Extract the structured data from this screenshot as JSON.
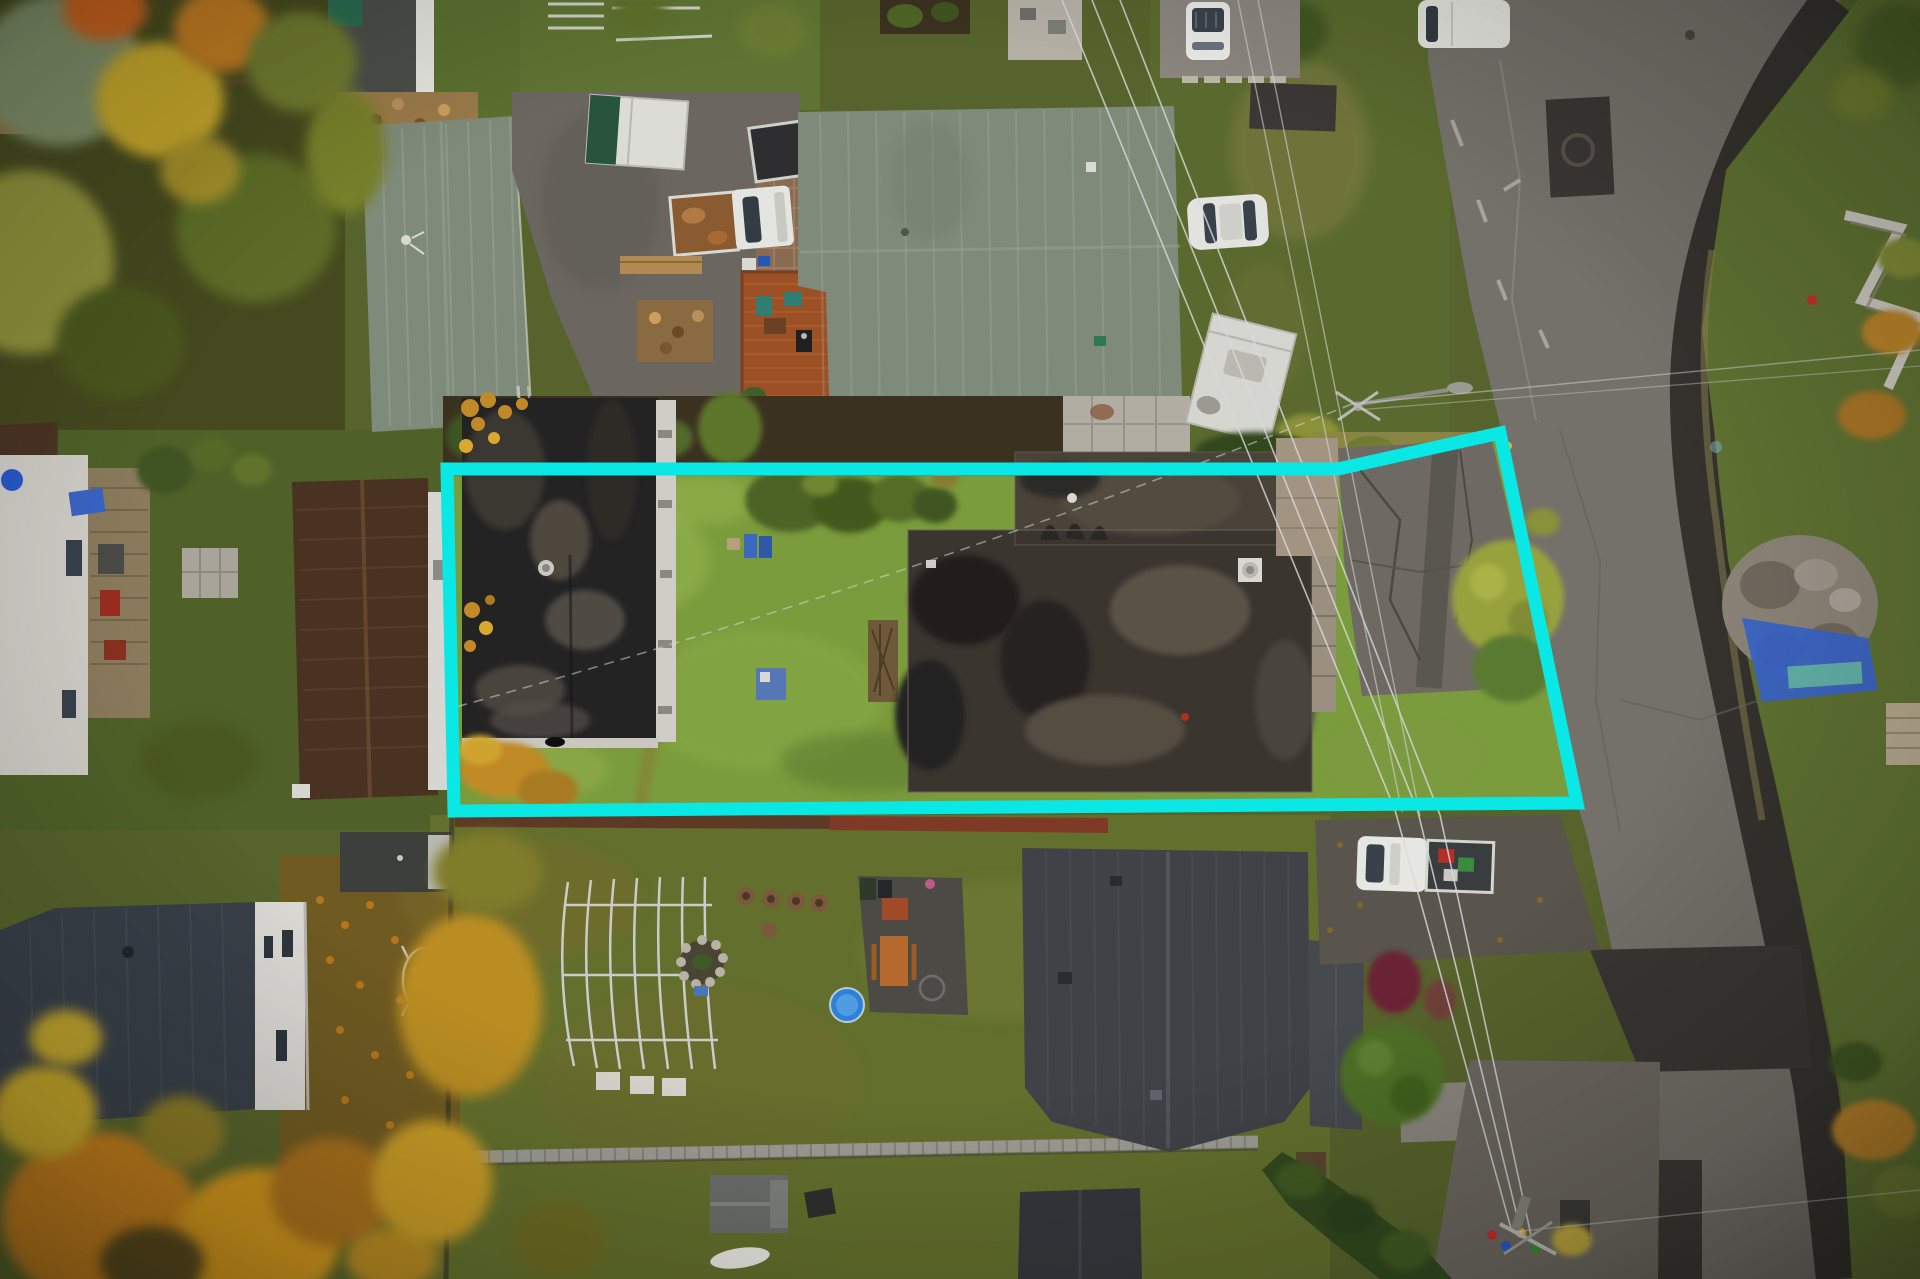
{
  "window": {
    "width": 1920,
    "height": 1279
  },
  "scene": {
    "kind": "aerial-drone-photo",
    "season": "autumn",
    "subject": "residential property lot highlighted with a boundary outline",
    "time_of_day": "overcast daylight"
  },
  "annotation": {
    "name": "property-boundary-outline",
    "color": "#0ae8e6",
    "stroke_width": 13,
    "points": "447,469 1338,469 1500,433 1577,803 454,811",
    "closed": true
  },
  "palette": {
    "lot_lawn": "#7a9c3c",
    "surrounding_grass": "#57632c",
    "road_asphalt": "#74706a",
    "fresh_asphalt": "#35322e",
    "flat_roof_black": "#232324",
    "flat_roof_house": "#3a352f",
    "shingle_gray_green": "#7f8b7a",
    "brown_roof": "#4a3425",
    "charcoal_roof": "#3f4347",
    "slate_roof": "#394049",
    "deck_wood": "#9c5026",
    "autumn_orange": "#c07b1d",
    "autumn_yellow": "#c8a72c",
    "tree_green": "#5d702c",
    "pool_blue": "#2f80d6",
    "tarp_blue": "#3a64c6",
    "vehicle_white": "#e6e6e2"
  },
  "objects": [
    "property-lot",
    "flat-roof-garage",
    "flat-roof-house",
    "lot-lawn",
    "lot-driveway",
    "gray-shingle-house-left",
    "gray-shingle-house-right",
    "deck-with-patio-furniture",
    "pickup-truck-dark-bed",
    "pickup-truck-rusty-bed",
    "camper-trailer",
    "rv-trailer",
    "white-suv",
    "white-van",
    "white-hatchback",
    "white-pickup-with-cargo",
    "street",
    "fresh-asphalt-band",
    "manhole-patch",
    "power-lines",
    "street-light",
    "utility-pole",
    "autumn-trees",
    "brown-roof-house",
    "white-house-with-deck",
    "slate-roof-house",
    "charcoal-roof-house",
    "garden-shed",
    "greenhouse-frame",
    "fire-pit",
    "kiddie-pool",
    "picnic-table",
    "boardwalk",
    "canoe",
    "rubble-pile",
    "blue-tarp",
    "retaining-wall",
    "hedges",
    "wood-pile",
    "stone-patio"
  ]
}
